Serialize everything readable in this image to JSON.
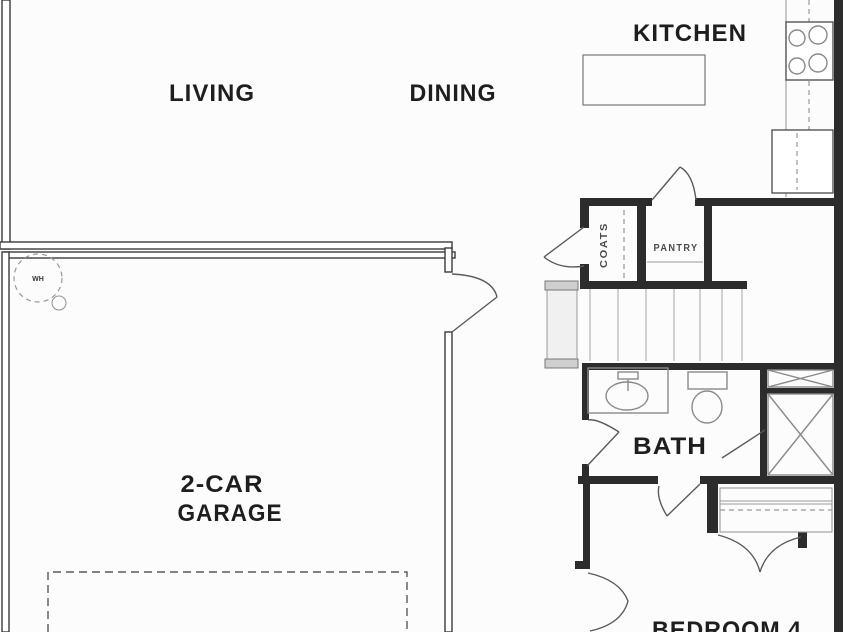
{
  "plan": {
    "title": "floor-plan",
    "rooms": {
      "living": {
        "label": "LIVING"
      },
      "dining": {
        "label": "DINING"
      },
      "kitchen": {
        "label": "KITCHEN"
      },
      "garage": {
        "label_line1": "2-CAR",
        "label_line2": "GARAGE"
      },
      "bath": {
        "label": "BATH"
      },
      "bedroom4": {
        "label": "BEDROOM 4"
      }
    },
    "closets": {
      "pantry": {
        "label": "PANTRY"
      },
      "coats": {
        "label": "COATS"
      }
    },
    "symbols": {
      "water_heater": {
        "label": "WH",
        "icon": "water-heater-icon"
      },
      "stove": {
        "icon": "stove-burners-icon"
      },
      "refrigerator": {
        "icon": "refrigerator-icon"
      },
      "kitchen_island": {
        "icon": "kitchen-island"
      },
      "bath_sink": {
        "icon": "bath-sink-icon"
      },
      "toilet": {
        "icon": "toilet-icon"
      },
      "shower": {
        "icon": "shower-icon"
      },
      "linen_cabinet": {
        "icon": "linen-cabinet-icon"
      },
      "stairs": {
        "icon": "staircase"
      },
      "garage_door": {
        "icon": "garage-door-dashed"
      },
      "bedroom_closet": {
        "icon": "closet-with-shelf"
      }
    },
    "colors": {
      "background": "#fcfcfc",
      "wall_dark": "#2c2c2c",
      "wall_outline": "#3b3b3b",
      "fixture_gray": "#8a8a8a",
      "stair_tread_gray": "#b3b3b3",
      "text": "#1e1e1e"
    }
  }
}
